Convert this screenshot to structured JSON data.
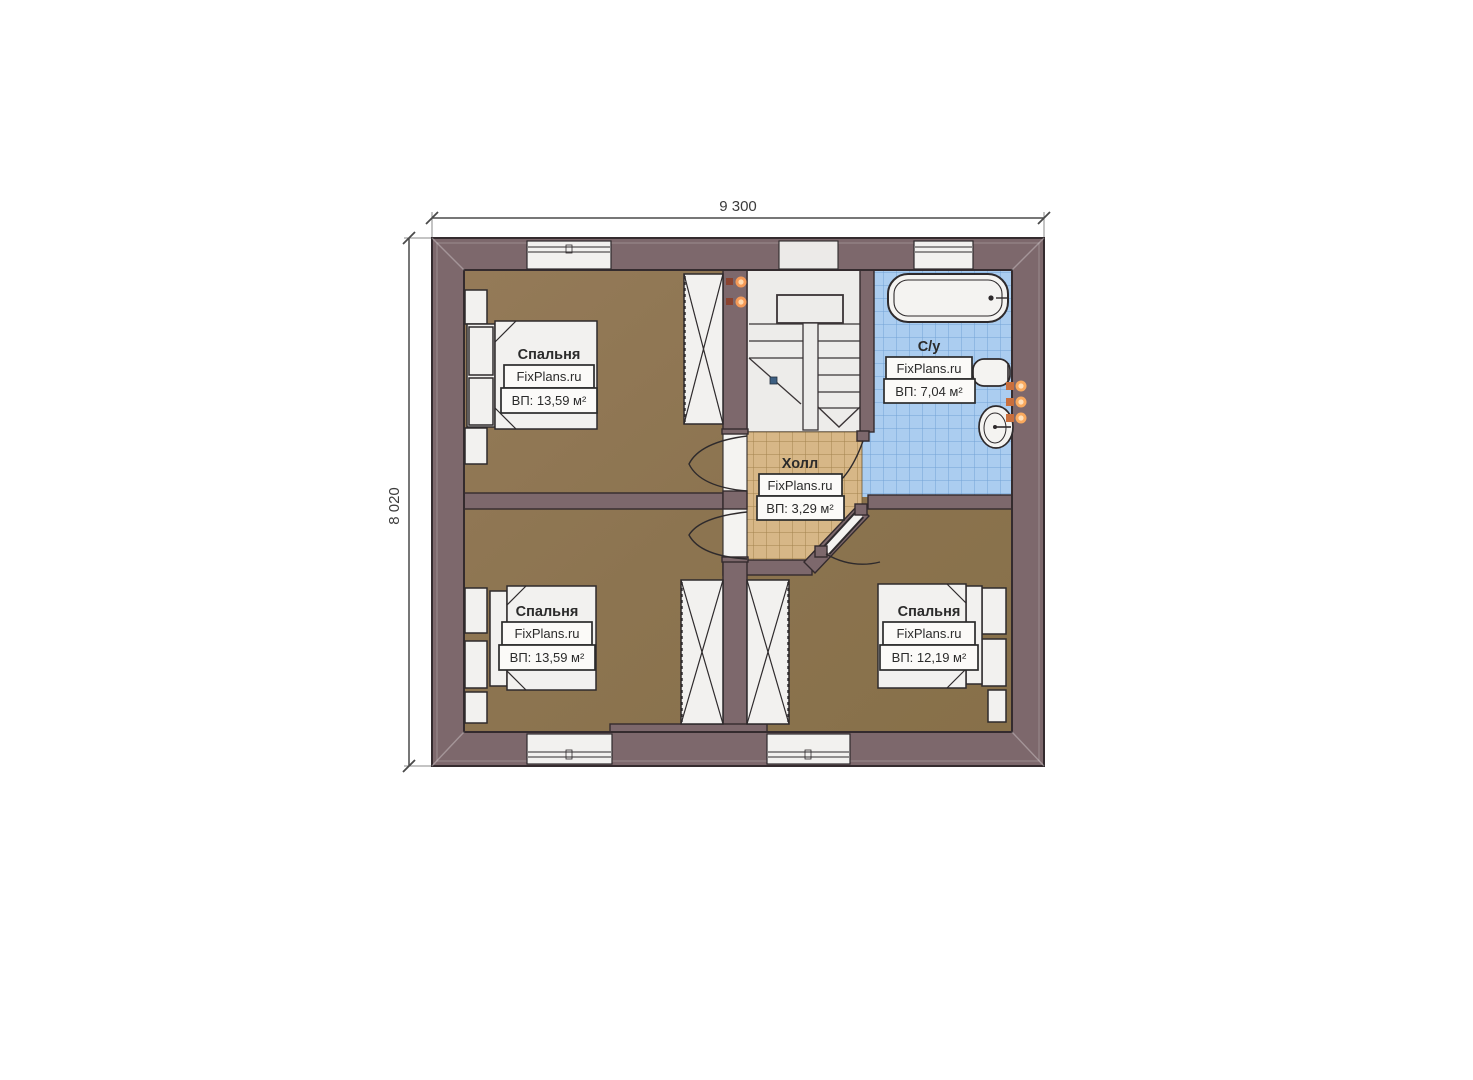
{
  "plan": {
    "dimensions": {
      "width_label": "9 300",
      "height_label": "8 020"
    },
    "rooms": [
      {
        "key": "bedroom-top-left",
        "name": "Спальня",
        "watermark": "FixPlans.ru",
        "area": "ВП: 13,59 м²"
      },
      {
        "key": "bedroom-bottom-left",
        "name": "Спальня",
        "watermark": "FixPlans.ru",
        "area": "ВП: 13,59 м²"
      },
      {
        "key": "bedroom-bottom-right",
        "name": "Спальня",
        "watermark": "FixPlans.ru",
        "area": "ВП: 12,19 м²"
      },
      {
        "key": "bathroom",
        "name": "С/у",
        "watermark": "FixPlans.ru",
        "area": "ВП: 7,04 м²"
      },
      {
        "key": "hall",
        "name": "Холл",
        "watermark": "FixPlans.ru",
        "area": "ВП: 3,29 м²"
      }
    ],
    "icons": {
      "bed": "bed-icon",
      "wardrobe": "wardrobe-icon",
      "bathtub": "bathtub-icon",
      "toilet": "toilet-icon",
      "sink": "sink-icon",
      "stairs": "stairs-icon",
      "door": "door-swing-icon",
      "window": "window-icon",
      "wall_light": "wall-light-icon"
    },
    "colors": {
      "wall": "#7d686c",
      "bedroom_floor": "#8d7553",
      "bath_floor": "#abcdf0",
      "hall_floor": "#d7b787",
      "stairs": "#edecea",
      "furniture": "#f2f1ef",
      "fixture_glow": "#f59a56"
    }
  }
}
